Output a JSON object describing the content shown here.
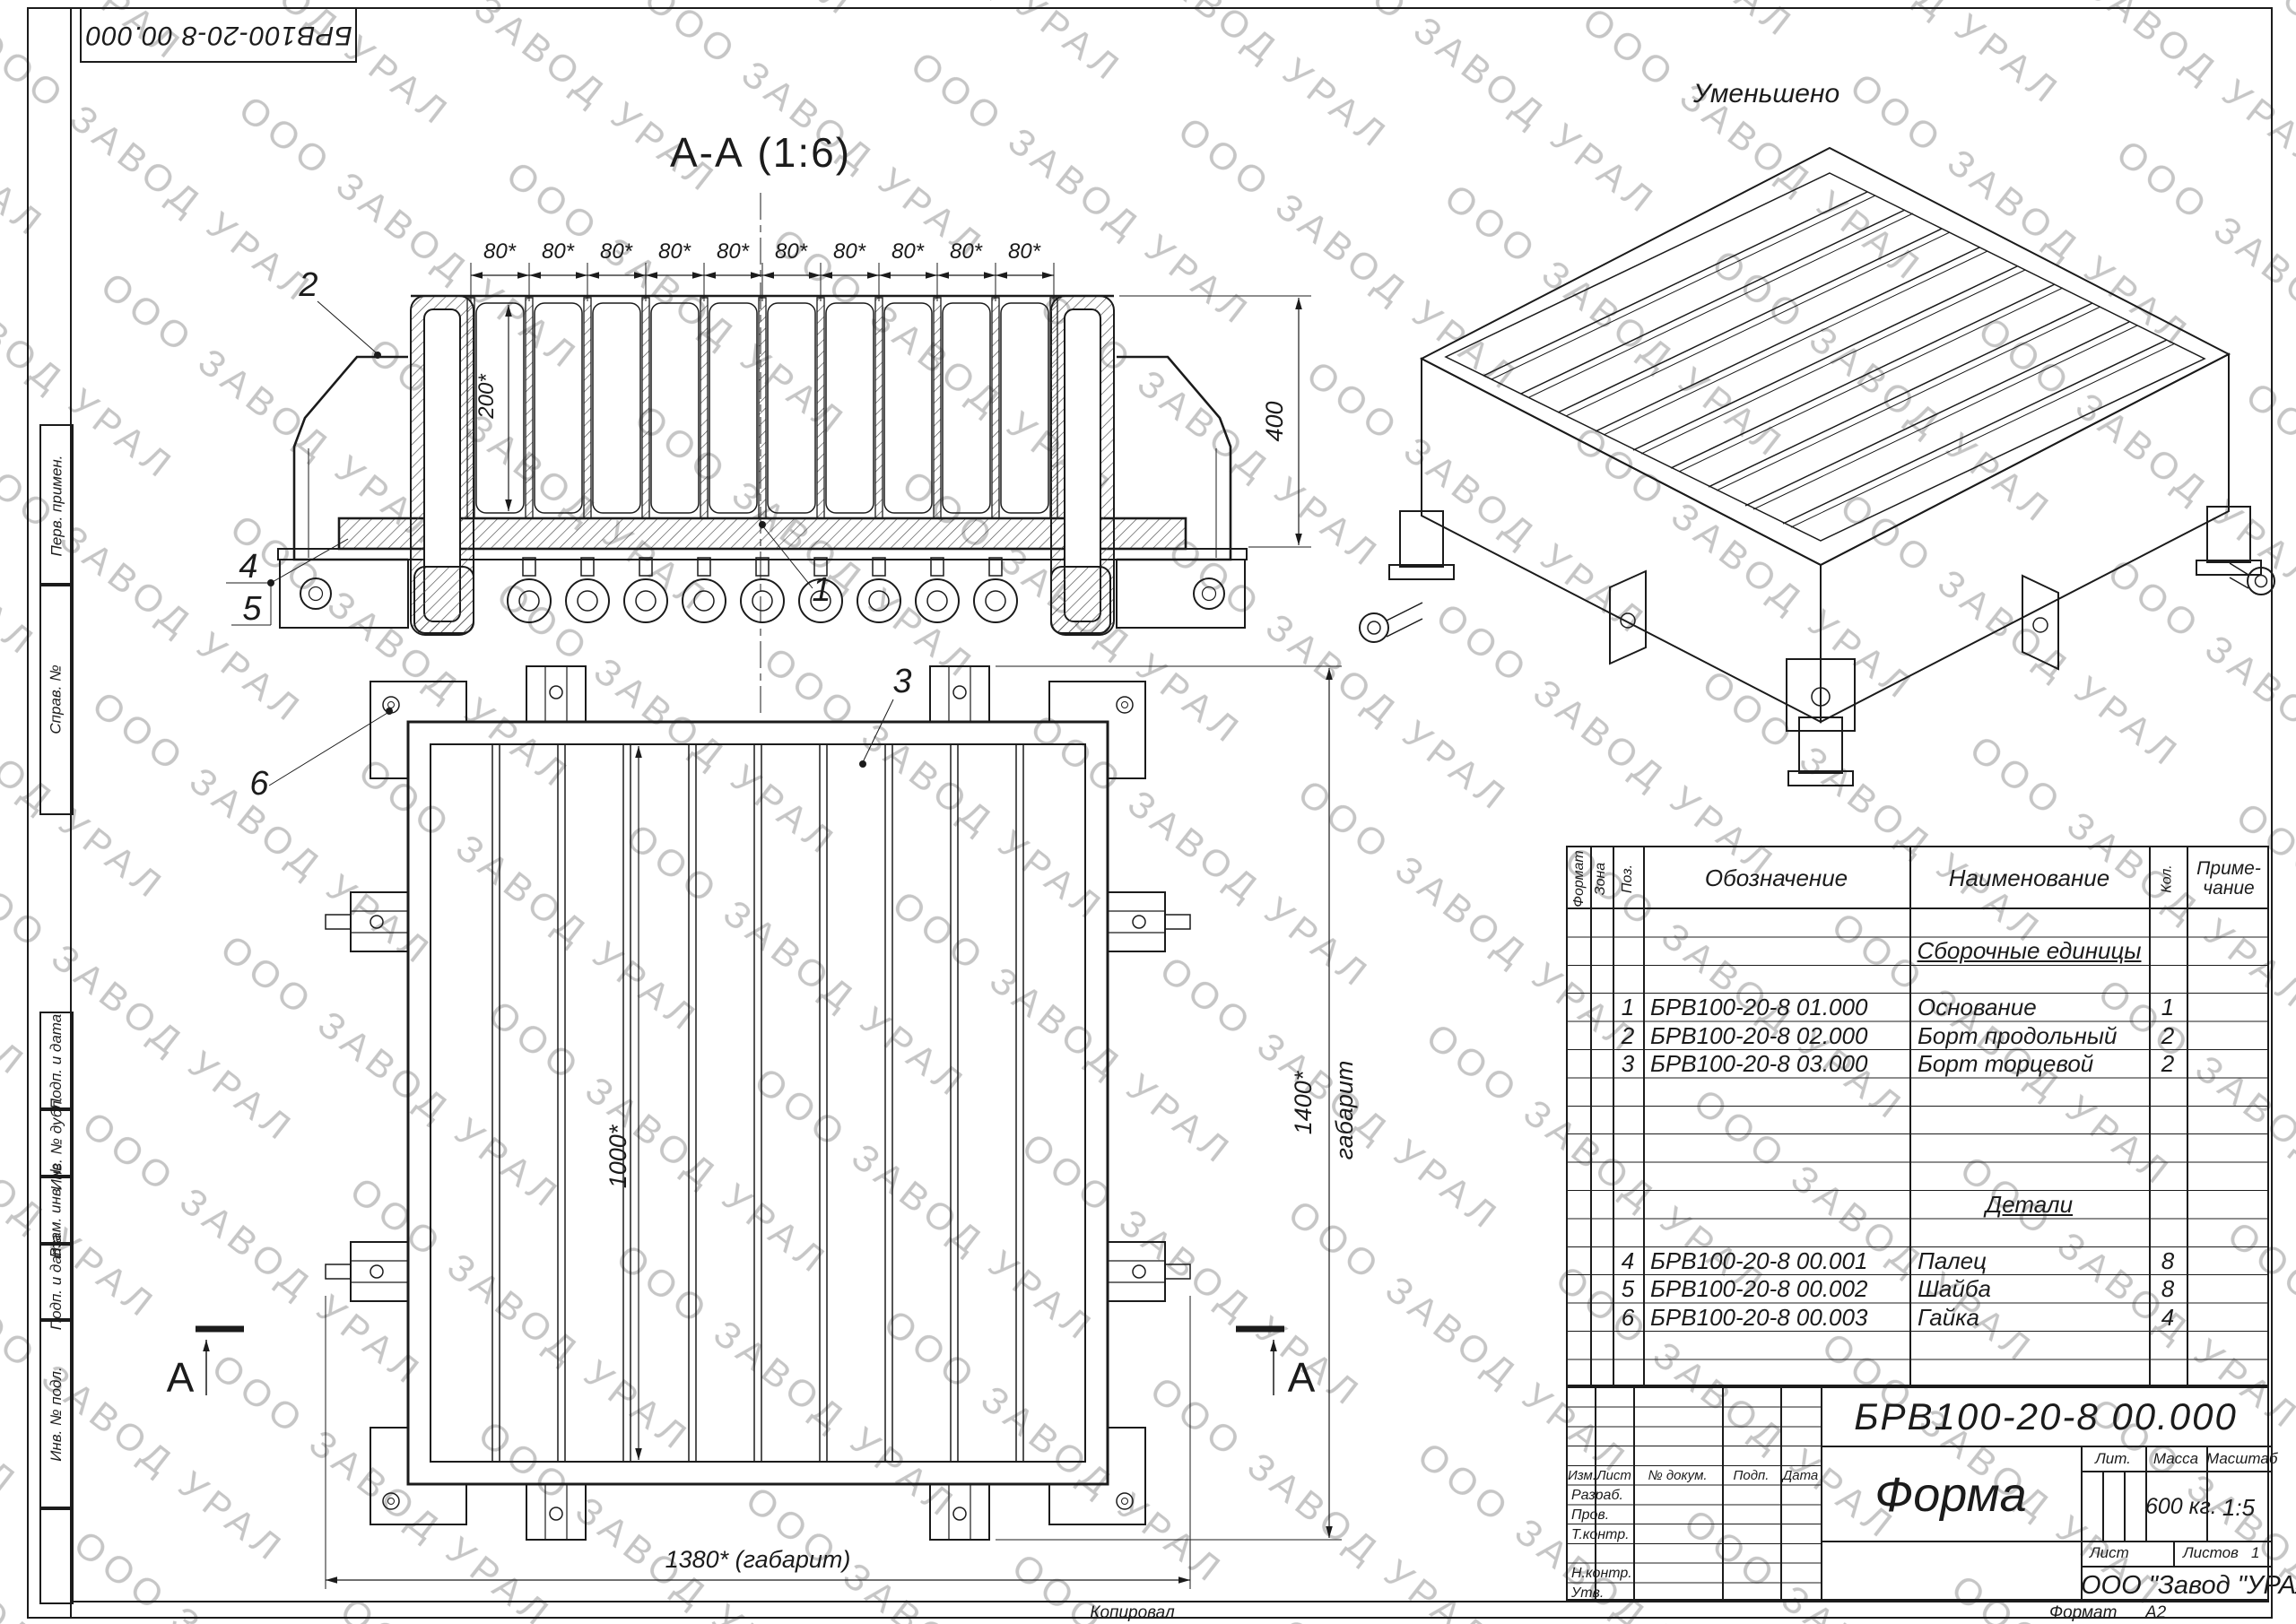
{
  "watermark": {
    "text": "ООО ЗАВОД УРАЛ",
    "color": "#c6c6c6"
  },
  "stamp_top_left": "БРВ100-20-8 00.000",
  "left_margin": {
    "labels": [
      "Перв. примен.",
      "Справ. №",
      "Подп. и дата",
      "Инв. № дубл.",
      "Взам. инв. №",
      "Подп. и дата",
      "Инв. № подл."
    ]
  },
  "section_view": {
    "title": "А-А (1:6)",
    "dim_bay": "80*",
    "dim_depth": "200*",
    "dim_height": "400",
    "callout_1": "1",
    "callout_2": "2",
    "callout_4": "4",
    "callout_5": "5"
  },
  "plan_view": {
    "dim_width_inner": "1000*",
    "dim_overall_x": "1380* (габарит)",
    "dim_overall_y": "1400*",
    "dim_overall_y_suffix": "габарит",
    "callout_3": "3",
    "callout_6": "6",
    "section_letter": "А"
  },
  "iso_view": {
    "label": "Уменьшено"
  },
  "spec_table": {
    "headers": {
      "format": "Формат",
      "zone": "Зона",
      "pos": "Поз.",
      "designation": "Обозначение",
      "name": "Наименование",
      "qty": "Кол.",
      "note_line1": "Приме-",
      "note_line2": "чание"
    },
    "group_assemblies": "Сборочные единицы",
    "group_parts": "Детали",
    "rows": [
      {
        "poz": "1",
        "designation": "БРВ100-20-8 01.000",
        "name": "Основание",
        "qty": "1"
      },
      {
        "poz": "2",
        "designation": "БРВ100-20-8 02.000",
        "name": "Борт продольный",
        "qty": "2"
      },
      {
        "poz": "3",
        "designation": "БРВ100-20-8 03.000",
        "name": "Борт торцевой",
        "qty": "2"
      },
      {
        "poz": "4",
        "designation": "БРВ100-20-8 00.001",
        "name": "Палец",
        "qty": "8"
      },
      {
        "poz": "5",
        "designation": "БРВ100-20-8 00.002",
        "name": "Шайба",
        "qty": "8"
      },
      {
        "poz": "6",
        "designation": "БРВ100-20-8 00.003",
        "name": "Гайка",
        "qty": "4"
      }
    ]
  },
  "title_block": {
    "designation": "БРВ100-20-8 00.000",
    "product_name": "Форма",
    "lit_label": "Лит.",
    "mass_label": "Масса",
    "scale_label": "Масштаб",
    "mass_value": "600 кг.",
    "scale_value": "1:5",
    "sheet_label": "Лист",
    "sheets_label": "Листов",
    "sheets_value": "1",
    "company": "ООО \"Завод \"УРАЛ\"",
    "change_header": {
      "izm": "Изм.",
      "list": "Лист",
      "doc": "№ докум.",
      "sign": "Подп.",
      "date": "Дата"
    },
    "roles": {
      "razrab": "Разраб.",
      "prov": "Пров.",
      "tkontr": "Т.контр.",
      "nkontr": "Н.контр.",
      "utv": "Утв."
    }
  },
  "footer": {
    "copied": "Копировал",
    "format_label": "Формат",
    "format_value": "А2"
  }
}
